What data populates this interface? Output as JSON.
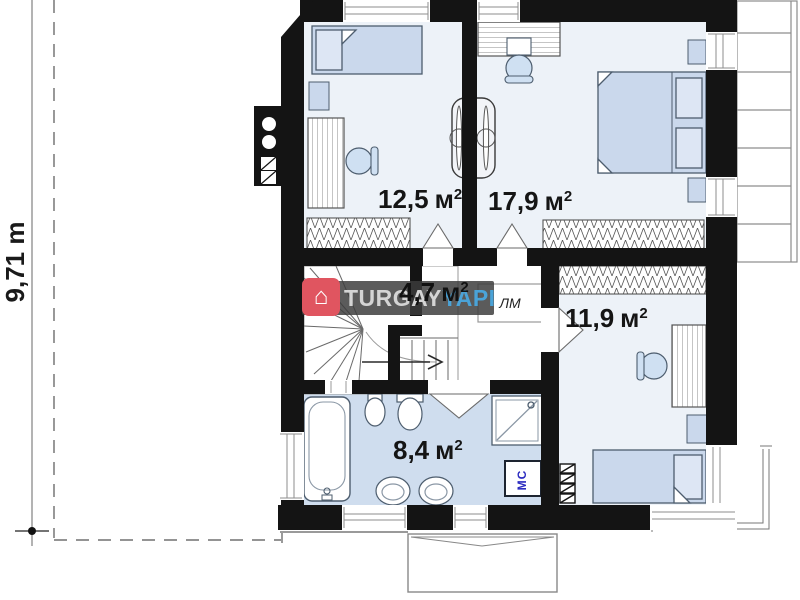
{
  "plan": {
    "dimension": {
      "value": "9,71 m"
    },
    "rooms": [
      {
        "id": "bedroom-top-left",
        "area": "12,5",
        "unit": "м",
        "power": "2"
      },
      {
        "id": "bedroom-top-right",
        "area": "17,9",
        "unit": "м",
        "power": "2"
      },
      {
        "id": "stair-hall",
        "area": "4,7",
        "unit": "м",
        "power": "2"
      },
      {
        "id": "bedroom-bottom",
        "area": "11,9",
        "unit": "м",
        "power": "2"
      },
      {
        "id": "bathroom",
        "area": "8,4",
        "unit": "м",
        "power": "2"
      }
    ],
    "labels": {
      "closet": "ЛМ",
      "washer": "МС"
    }
  },
  "watermark": {
    "brand": "TURGAY",
    "brand2": "YAPI",
    "logo": "house-icon",
    "logo_glyph": "⌂",
    "banner_color": "#3c3c3c",
    "logo_color": "#e05560",
    "brand2_color": "#4aa3d8"
  }
}
